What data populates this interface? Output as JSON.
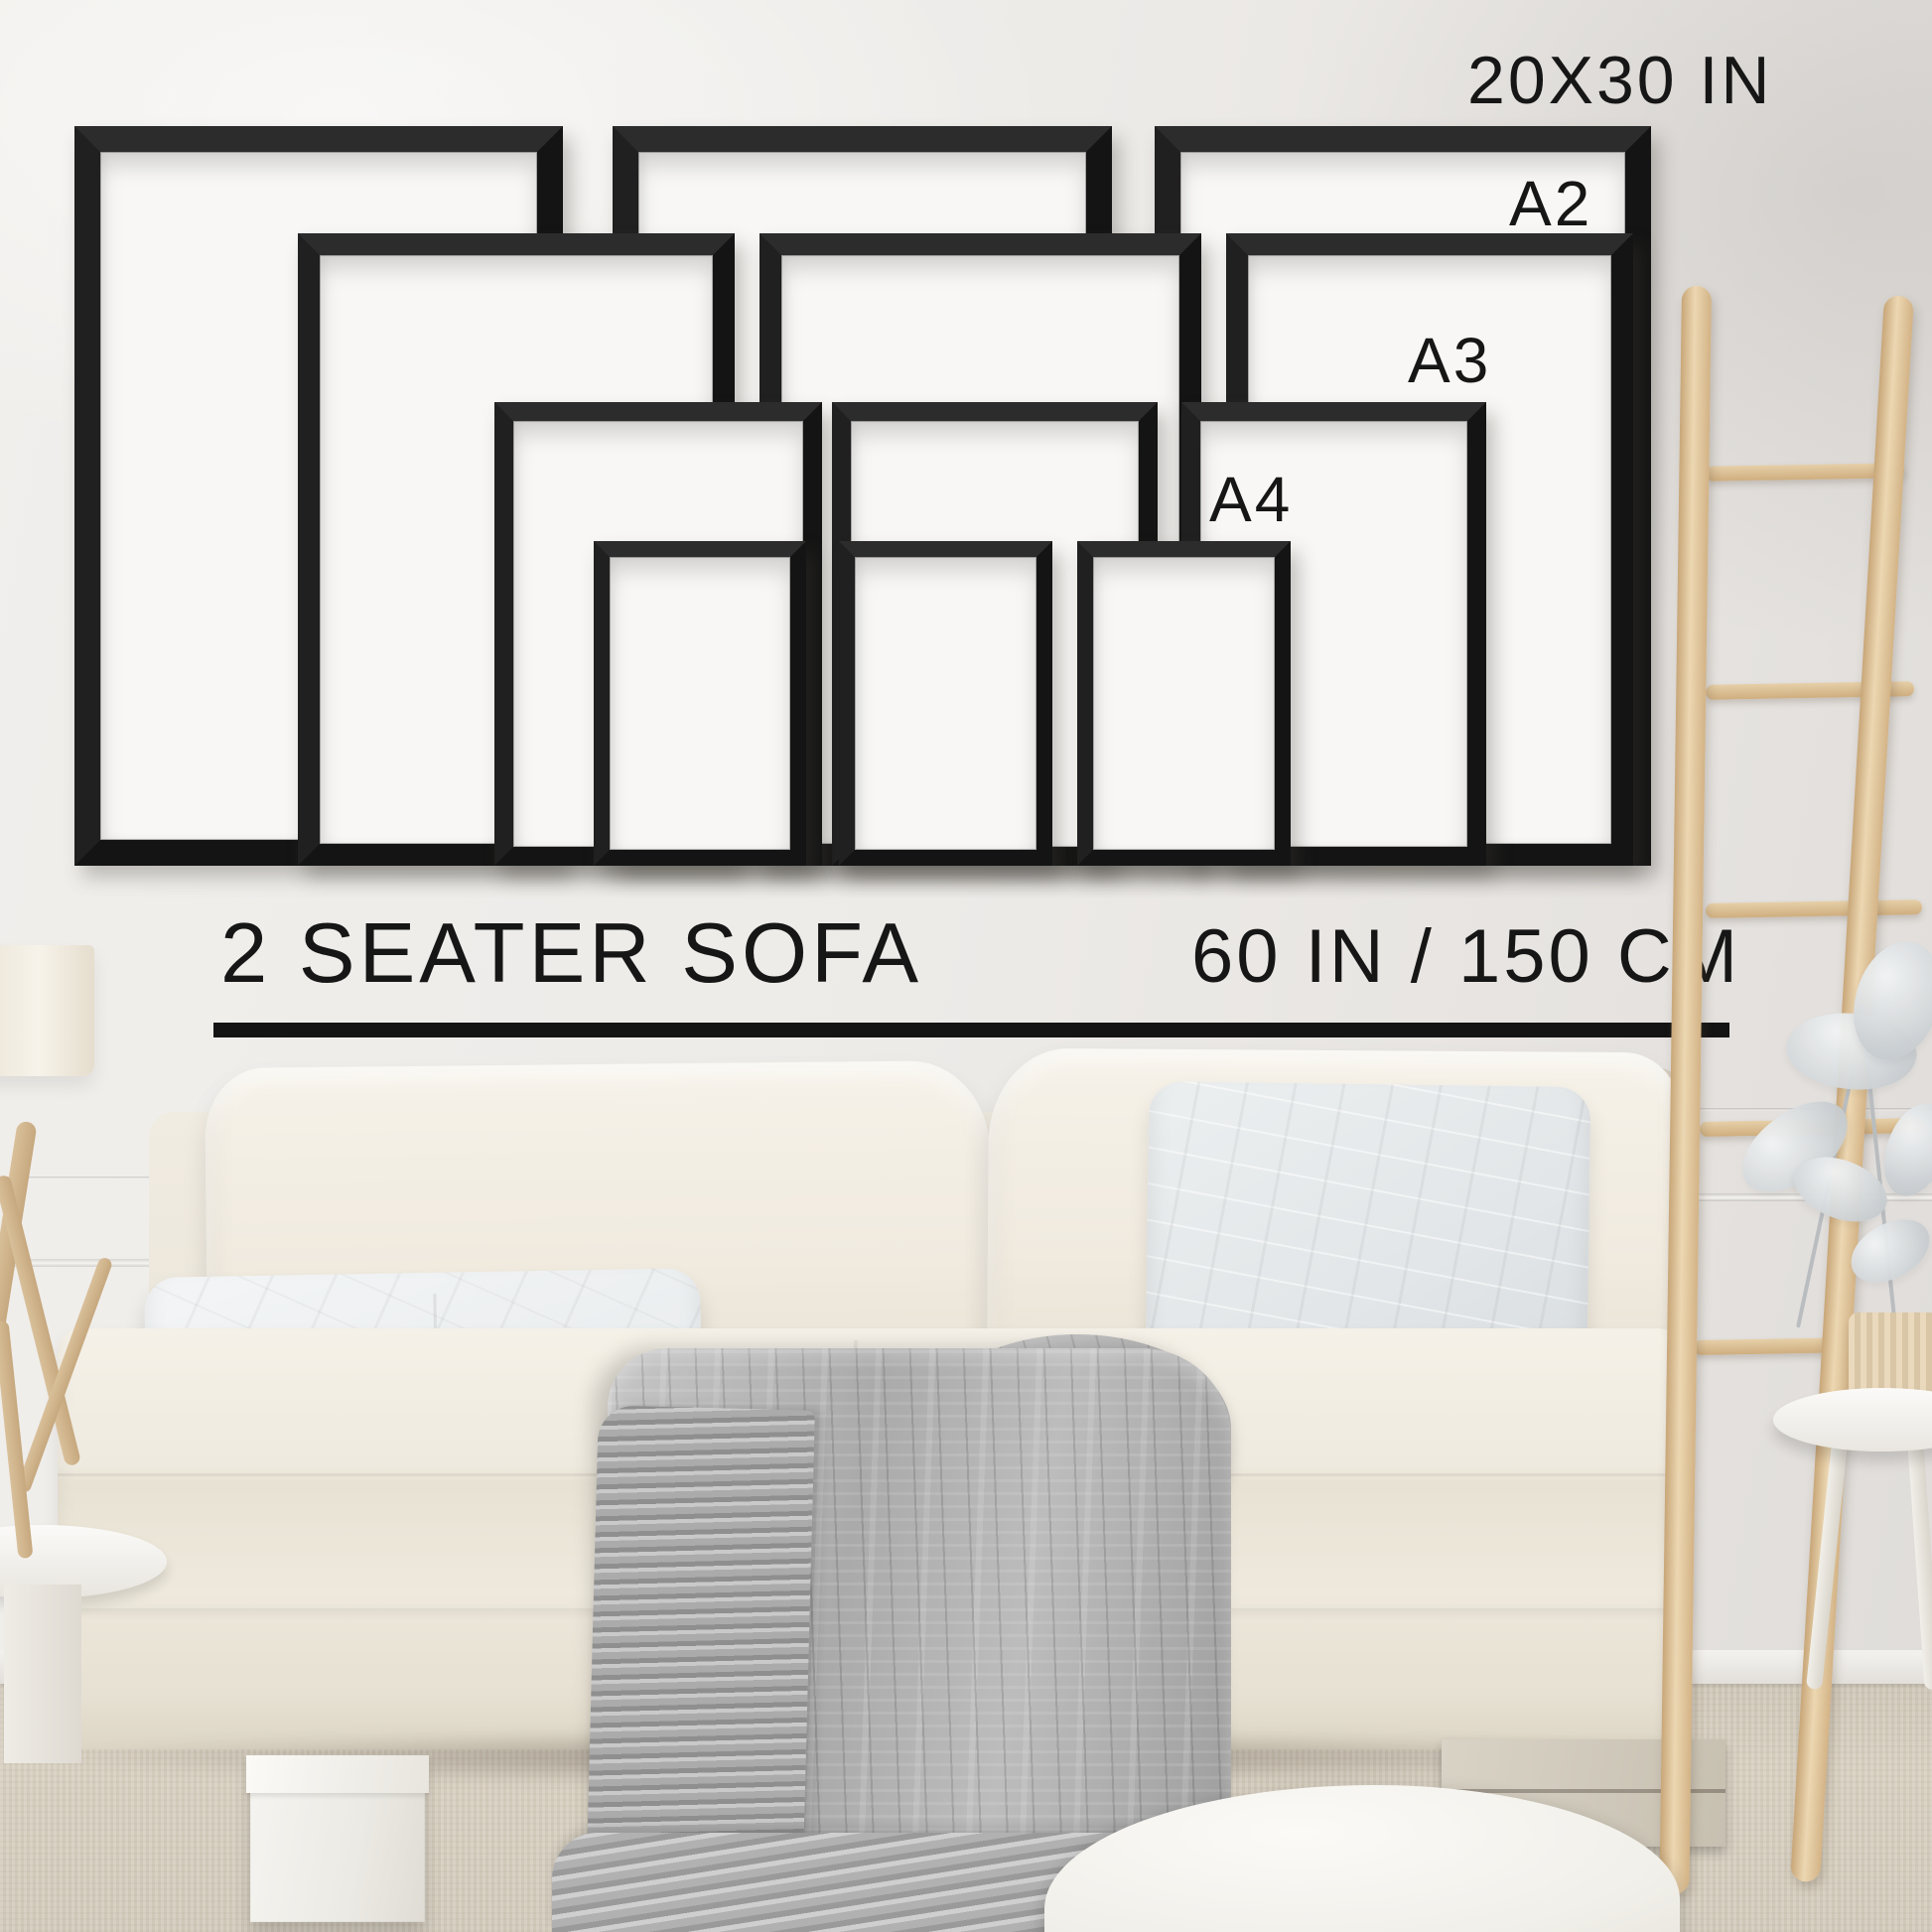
{
  "size_guide": {
    "max_size_label": "20X30 IN",
    "sizes": [
      {
        "label": "A2"
      },
      {
        "label": "A3"
      },
      {
        "label": "A4"
      }
    ],
    "frame_count": 12,
    "frame_color": "#141414",
    "mat_color": "#f8f7f5"
  },
  "scale_reference": {
    "object_label": "2 SEATER SOFA",
    "width_label": "60 IN / 150 CM",
    "divider_color": "#141414"
  },
  "palette": {
    "wall": "#edebe8",
    "floor": "#d3cbbc",
    "sofa_cream": "#f0eadf",
    "pillow_gray": "#e2e6e8",
    "blanket_gray": "#aaaaaa",
    "wood": "#d3b386",
    "text": "#161616"
  }
}
